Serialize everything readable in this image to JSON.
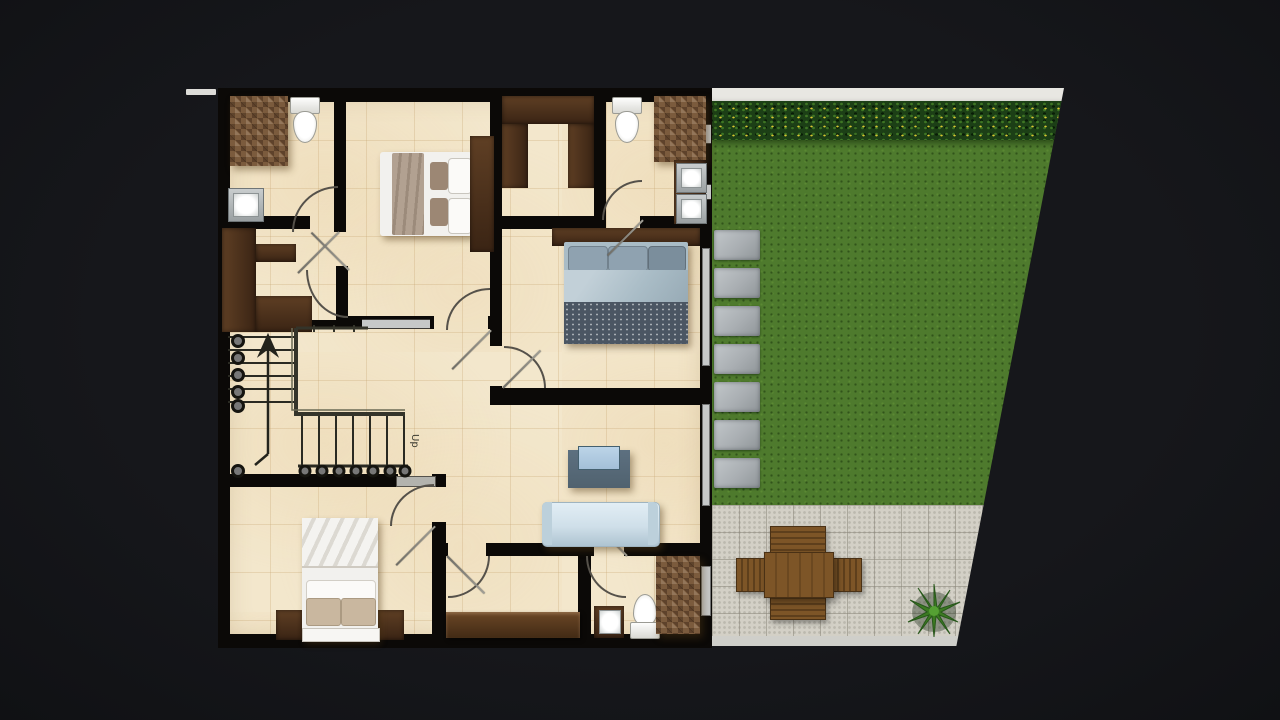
{
  "scene": {
    "description": "3D rendered residential floor plan with bedrooms, bathrooms, U-shaped staircase, side lawn with stepping stones, hedge and paved patio with dining set",
    "stairs_label": "Up"
  },
  "colors": {
    "background": "#16171b",
    "plan_floor": "#f3e7cc",
    "wall": "#0b0907",
    "wood_dark": "#3a2414",
    "wood_mid": "#5f3f24",
    "mosaic": "#7b5b3d",
    "lawn": "#4e7a2d",
    "hedge": "#1c3f16",
    "hedge_flower": "#d6c632",
    "paver": "#a9aeb2",
    "patio": "#d3d0c6",
    "table_wood": "#7d5527",
    "sofa": "#cfdfe9",
    "bed_blue": "#a9bcc6",
    "bed_weave": "#4b5663",
    "bed_white": "#f2f1ee",
    "pillow_tan": "#c9b79f",
    "blanket_taupe": "#b2a191",
    "tv_unit": "#50626f",
    "tv_screen": "#a3c0d8",
    "fixture_white": "#f6f6f4",
    "glass": "#c6c8c8",
    "arc_stroke": "#55514a",
    "plant_green": "#3c7a22",
    "top_strip": "#e8e7e2",
    "boundary_mark": "#dddcd8"
  },
  "elements": [
    "shower-mosaic",
    "toilet",
    "sink",
    "double-bed-white",
    "double-bed-blue",
    "wardrobe-u",
    "wardrobe-e",
    "staircase-up",
    "sofa",
    "tv-unit",
    "dresser",
    "vanity-sink",
    "hedge",
    "lawn",
    "stepping-stones",
    "patio",
    "dining-table",
    "garden-chair",
    "potted-plant"
  ]
}
